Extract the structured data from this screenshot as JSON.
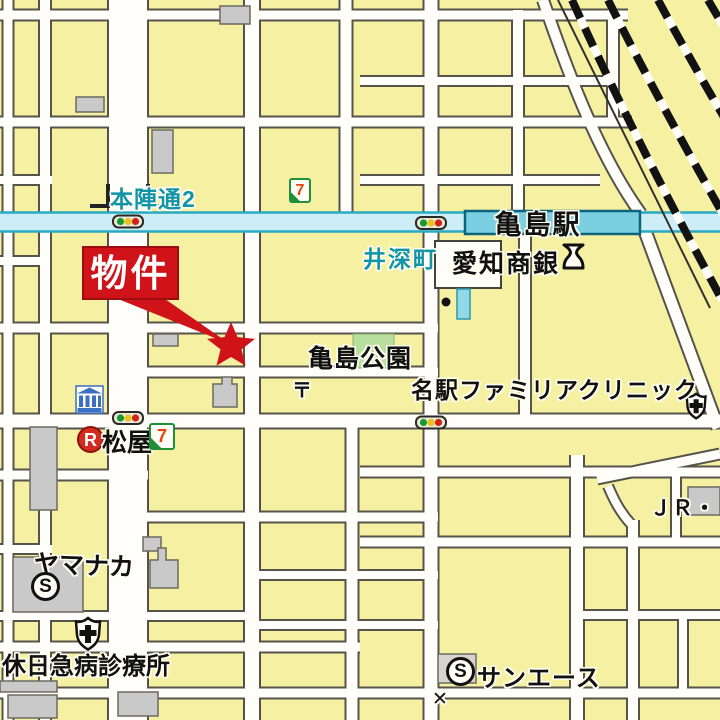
{
  "labels": {
    "property": "物件",
    "station": "亀島駅",
    "street_honjin": "本陣通2",
    "area_ibuka": "井深町",
    "bank_aichi": "愛知商銀",
    "park_kameshima": "亀島公園",
    "clinic_meieki": "名駅ファミリアクリニック",
    "matsuya": "松屋",
    "yamanaka": "ヤマナカ",
    "holiday_clinic": "休日急病診療所",
    "sun_ace": "サンエース",
    "jr": "ＪＲ・",
    "post_mark": "〒",
    "x_mark": "✕"
  },
  "badges": {
    "restaurant": "R",
    "supermarket": "S",
    "seven_eleven": "7"
  },
  "colors": {
    "property_red": "#cf1318",
    "road_cyan_fill": "#cdeef6",
    "road_cyan_edge": "#2aa9c2",
    "station_cyan": "#7ccfe0",
    "park_green": "#b9df9e",
    "block_yellow": "#f6f1a2",
    "street_white": "#fffefa",
    "label_teal": "#1194a8"
  }
}
